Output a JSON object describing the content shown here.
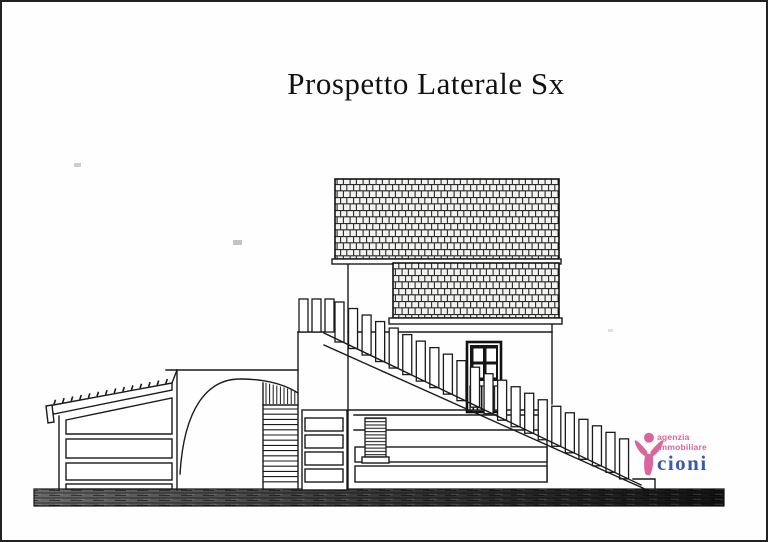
{
  "title": "Prospetto Laterale Sx",
  "logo": {
    "agency_line1": "agenzia",
    "agency_line2": "immobiliare",
    "agency_name": "cioni",
    "pink": "#d9659b",
    "blue": "#3a5aa8"
  },
  "colors": {
    "ink": "#1a1a1a",
    "paper": "#fefefe",
    "ground_dark": "#161616",
    "ground_mid": "#5e5e5e"
  }
}
